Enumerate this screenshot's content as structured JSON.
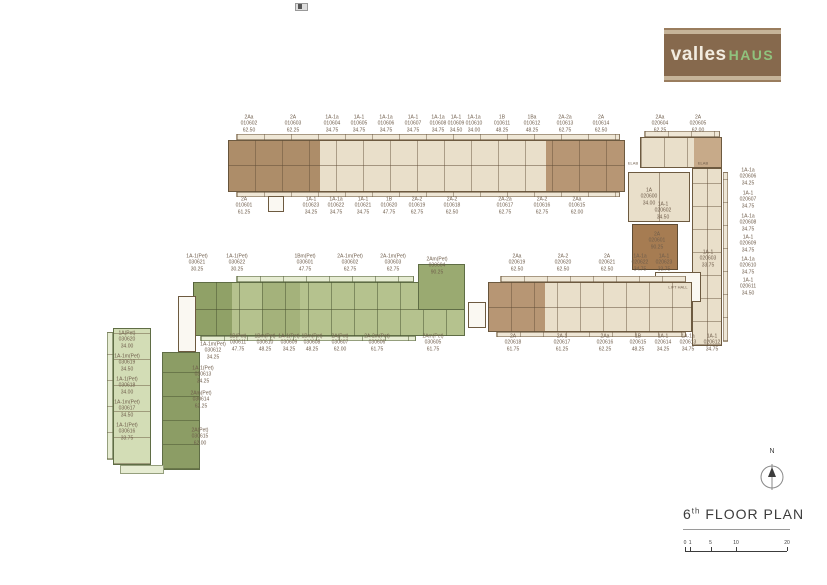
{
  "logo": {
    "brand_left": "valles",
    "brand_right": "HAUS"
  },
  "plan_title": {
    "number": "6",
    "ordinal": "th",
    "label": "FLOOR PLAN"
  },
  "compass_label": "N",
  "scale": {
    "ticks": [
      "0",
      "1",
      "5",
      "10",
      "20"
    ]
  },
  "colors": {
    "logo_brown": "#86694d",
    "logo_stripe": "#c6b499",
    "logo_green": "#90c27d",
    "unit_beige": "#e9dfca",
    "unit_brown": "#ad8d69",
    "unit_brown_highlight": "#a67c52",
    "unit_green": "#b5c28e",
    "unit_green_dark": "#90a167",
    "unit_green_light": "#d3ddb6",
    "label_text": "#6f5d4b"
  },
  "misc_labels": [
    {
      "name": "lift-hall-label",
      "text": "LIFT HALL",
      "x": 678,
      "y": 287
    },
    {
      "name": "elab-label-1",
      "text": "ELAB",
      "x": 633,
      "y": 163
    },
    {
      "name": "elab-label-2",
      "text": "ELAB",
      "x": 703,
      "y": 163
    }
  ],
  "unit_labels": [
    {
      "type": "2Aa",
      "no": "010602",
      "area": "62.50",
      "x": 249,
      "y": 124
    },
    {
      "type": "2A",
      "no": "010603",
      "area": "62.25",
      "x": 293,
      "y": 124
    },
    {
      "type": "1A-1a",
      "no": "010604",
      "area": "34.75",
      "x": 332,
      "y": 124
    },
    {
      "type": "1A-1",
      "no": "010605",
      "area": "34.75",
      "x": 359,
      "y": 124
    },
    {
      "type": "1A-1a",
      "no": "010606",
      "area": "34.75",
      "x": 386,
      "y": 124
    },
    {
      "type": "1A-1",
      "no": "010607",
      "area": "34.75",
      "x": 413,
      "y": 124
    },
    {
      "type": "1A-1a",
      "no": "010608",
      "area": "34.75",
      "x": 438,
      "y": 124
    },
    {
      "type": "1A-1",
      "no": "010609",
      "area": "34.50",
      "x": 456,
      "y": 124
    },
    {
      "type": "1A-1a",
      "no": "010610",
      "area": "34.00",
      "x": 474,
      "y": 124
    },
    {
      "type": "1B",
      "no": "010611",
      "area": "48.25",
      "x": 502,
      "y": 124
    },
    {
      "type": "1Ba",
      "no": "010612",
      "area": "48.25",
      "x": 532,
      "y": 124
    },
    {
      "type": "2A-2a",
      "no": "010613",
      "area": "62.75",
      "x": 565,
      "y": 124
    },
    {
      "type": "2A",
      "no": "010614",
      "area": "62.50",
      "x": 601,
      "y": 124
    },
    {
      "type": "2Aa",
      "no": "020604",
      "area": "62.25",
      "x": 660,
      "y": 124
    },
    {
      "type": "2A",
      "no": "020605",
      "area": "62.00",
      "x": 698,
      "y": 124
    },
    {
      "type": "2A",
      "no": "010601",
      "area": "61.25",
      "x": 244,
      "y": 206
    },
    {
      "type": "1A-1",
      "no": "010623",
      "area": "34.25",
      "x": 311,
      "y": 206
    },
    {
      "type": "1A-1a",
      "no": "010622",
      "area": "34.75",
      "x": 336,
      "y": 206
    },
    {
      "type": "1A-1",
      "no": "010621",
      "area": "34.75",
      "x": 363,
      "y": 206
    },
    {
      "type": "1B",
      "no": "010620",
      "area": "47.75",
      "x": 389,
      "y": 206
    },
    {
      "type": "2A-2",
      "no": "010619",
      "area": "62.75",
      "x": 417,
      "y": 206
    },
    {
      "type": "2A-2",
      "no": "010618",
      "area": "62.50",
      "x": 452,
      "y": 206
    },
    {
      "type": "2A-2a",
      "no": "010617",
      "area": "62.75",
      "x": 505,
      "y": 206
    },
    {
      "type": "2A-2",
      "no": "010616",
      "area": "62.75",
      "x": 542,
      "y": 206
    },
    {
      "type": "2Aa",
      "no": "010615",
      "area": "62.00",
      "x": 577,
      "y": 206
    },
    {
      "type": "1A",
      "no": "020600",
      "area": "34.00",
      "x": 649,
      "y": 197
    },
    {
      "type": "1A-1",
      "no": "020602",
      "area": "34.50",
      "x": 663,
      "y": 211
    },
    {
      "type": "2A",
      "no": "020601",
      "area": "90.25",
      "x": 657,
      "y": 241
    },
    {
      "type": "1A-1",
      "no": "020603",
      "area": "33.75",
      "x": 708,
      "y": 259
    },
    {
      "type": "1A-1a",
      "no": "020606",
      "area": "34.25",
      "x": 748,
      "y": 177
    },
    {
      "type": "1A-1",
      "no": "020607",
      "area": "34.75",
      "x": 748,
      "y": 200
    },
    {
      "type": "1A-1a",
      "no": "020608",
      "area": "34.75",
      "x": 748,
      "y": 223
    },
    {
      "type": "1A-1",
      "no": "020609",
      "area": "34.75",
      "x": 748,
      "y": 244
    },
    {
      "type": "1A-1a",
      "no": "020610",
      "area": "34.75",
      "x": 748,
      "y": 266
    },
    {
      "type": "1A-1",
      "no": "020611",
      "area": "34.50",
      "x": 748,
      "y": 287
    },
    {
      "type": "2Aa",
      "no": "020619",
      "area": "62.50",
      "x": 517,
      "y": 263
    },
    {
      "type": "2A-2",
      "no": "020620",
      "area": "62.50",
      "x": 563,
      "y": 263
    },
    {
      "type": "2A",
      "no": "020621",
      "area": "62.50",
      "x": 607,
      "y": 263
    },
    {
      "type": "1A-1a",
      "no": "020622",
      "area": "34.75",
      "x": 640,
      "y": 263
    },
    {
      "type": "1A-1",
      "no": "020623",
      "area": "33.75",
      "x": 664,
      "y": 263
    },
    {
      "type": "2A",
      "no": "020618",
      "area": "61.75",
      "x": 513,
      "y": 343
    },
    {
      "type": "2A-1",
      "no": "020617",
      "area": "61.25",
      "x": 562,
      "y": 343
    },
    {
      "type": "2Aa",
      "no": "020616",
      "area": "62.25",
      "x": 605,
      "y": 343
    },
    {
      "type": "1B",
      "no": "020615",
      "area": "48.25",
      "x": 638,
      "y": 343
    },
    {
      "type": "1A-1",
      "no": "020614",
      "area": "34.25",
      "x": 663,
      "y": 343
    },
    {
      "type": "1A-1a",
      "no": "020613",
      "area": "34.75",
      "x": 688,
      "y": 343
    },
    {
      "type": "1A-1",
      "no": "020612",
      "area": "34.75",
      "x": 712,
      "y": 343
    },
    {
      "type": "1A-1(Pet)",
      "no": "030621",
      "area": "30.25",
      "x": 197,
      "y": 263
    },
    {
      "type": "1A-1(Pet)",
      "no": "030622",
      "area": "30.25",
      "x": 237,
      "y": 263
    },
    {
      "type": "1Bm(Pet)",
      "no": "030601",
      "area": "47.75",
      "x": 305,
      "y": 263
    },
    {
      "type": "2A-1m(Pet)",
      "no": "030602",
      "area": "62.75",
      "x": 350,
      "y": 263
    },
    {
      "type": "2A-1m(Pet)",
      "no": "030603",
      "area": "62.75",
      "x": 393,
      "y": 263
    },
    {
      "type": "2Am(Pet)",
      "no": "030604",
      "area": "90.25",
      "x": 437,
      "y": 266
    },
    {
      "type": "1A-1m(Pet)",
      "no": "030612",
      "area": "34.25",
      "x": 213,
      "y": 351
    },
    {
      "type": "1B(Pet)",
      "no": "030611",
      "area": "47.75",
      "x": 238,
      "y": 343
    },
    {
      "type": "1Bm(Pet)",
      "no": "030610",
      "area": "48.25",
      "x": 265,
      "y": 343
    },
    {
      "type": "1A-1(Pet)",
      "no": "030609",
      "area": "34.25",
      "x": 289,
      "y": 343
    },
    {
      "type": "1Bm(Pet)",
      "no": "030608",
      "area": "48.25",
      "x": 312,
      "y": 343
    },
    {
      "type": "2A(Pet)",
      "no": "030607",
      "area": "62.00",
      "x": 340,
      "y": 343
    },
    {
      "type": "2A-2m(Pet)",
      "no": "030606",
      "area": "61.75",
      "x": 377,
      "y": 343
    },
    {
      "type": "2Am(Pet)",
      "no": "030605",
      "area": "61.75",
      "x": 433,
      "y": 343
    },
    {
      "type": "1A(Pet)",
      "no": "030620",
      "area": "34.00",
      "x": 127,
      "y": 340
    },
    {
      "type": "1A-1m(Pet)",
      "no": "030619",
      "area": "34.50",
      "x": 127,
      "y": 363
    },
    {
      "type": "1A-1(Pet)",
      "no": "030618",
      "area": "34.00",
      "x": 127,
      "y": 386
    },
    {
      "type": "1A-1m(Pet)",
      "no": "030617",
      "area": "34.50",
      "x": 127,
      "y": 409
    },
    {
      "type": "1A-1(Pet)",
      "no": "030616",
      "area": "33.75",
      "x": 127,
      "y": 432
    },
    {
      "type": "1A-1(Pet)",
      "no": "030613",
      "area": "34.25",
      "x": 203,
      "y": 375
    },
    {
      "type": "2Am(Pet)",
      "no": "030614",
      "area": "62.25",
      "x": 201,
      "y": 400
    },
    {
      "type": "2A(Pet)",
      "no": "030615",
      "area": "62.00",
      "x": 200,
      "y": 437
    }
  ]
}
